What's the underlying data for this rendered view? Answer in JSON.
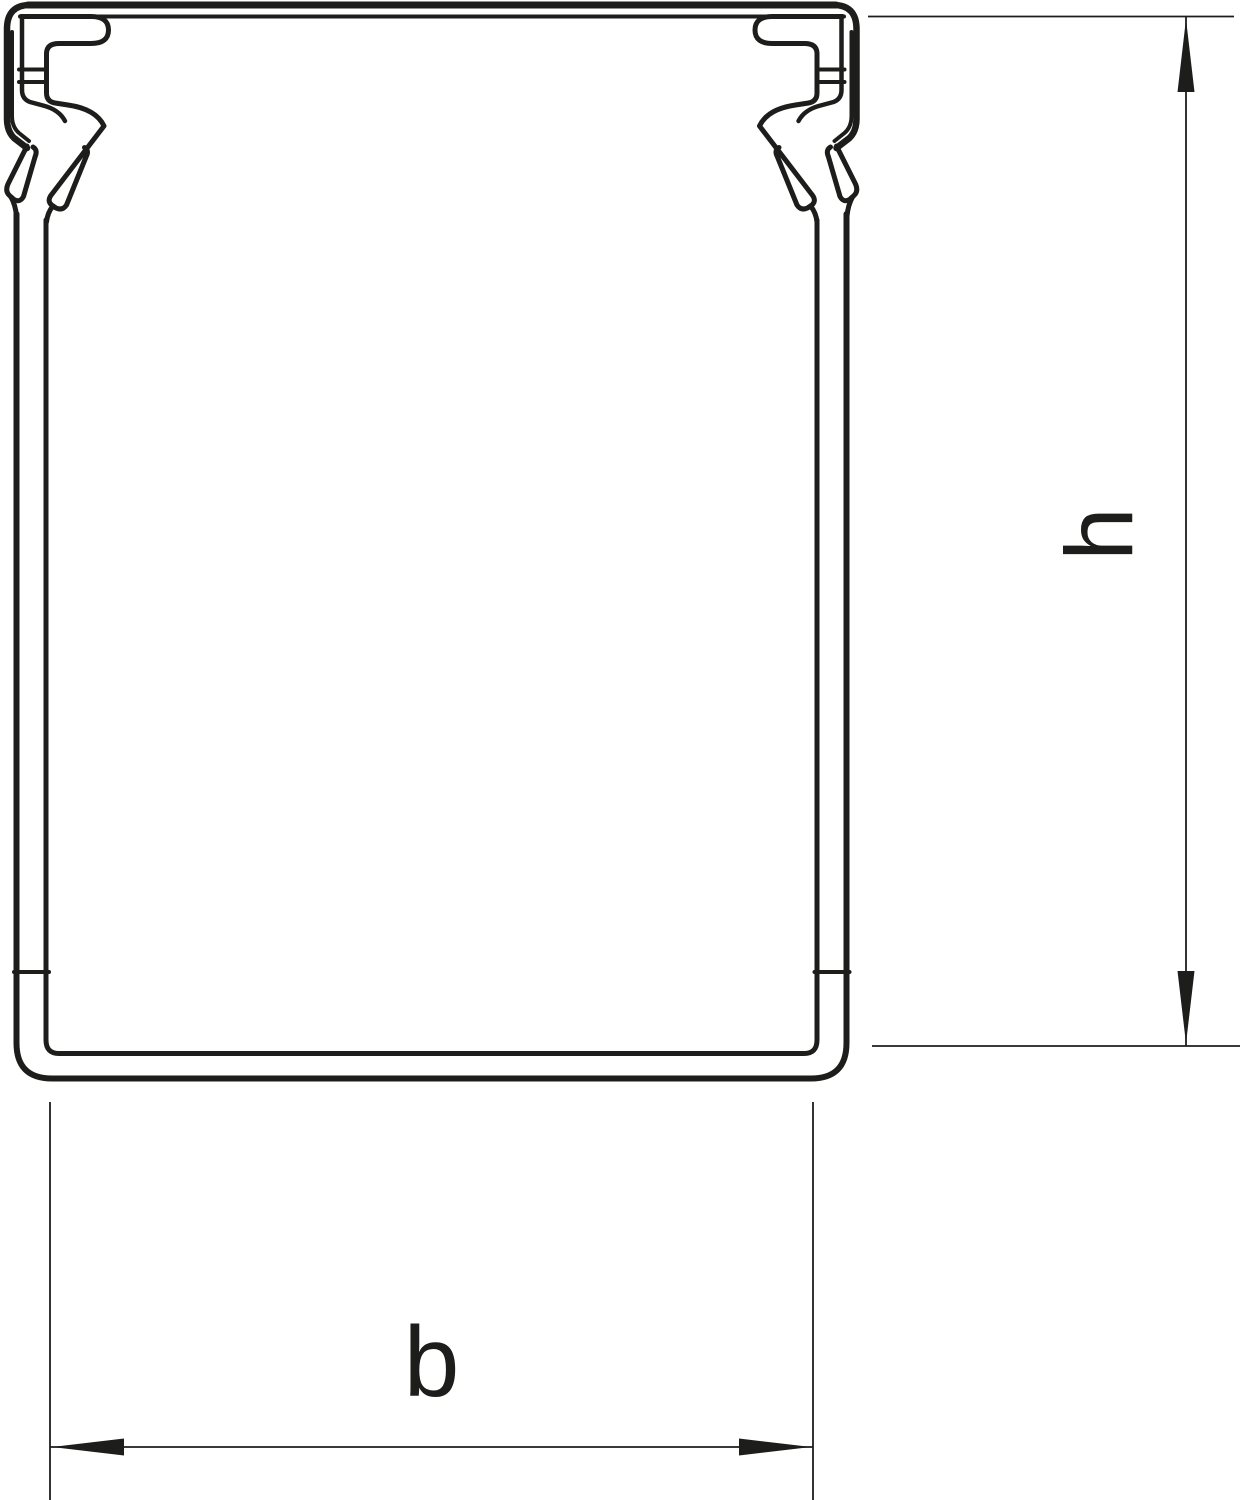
{
  "drawing": {
    "title": "Cable trunking profile cross-section",
    "description": "Technical line drawing of a wiring duct (cable trunking) cross-section with snap-on cover clips at both upper corners",
    "labels": {
      "height": "h",
      "width": "b"
    }
  },
  "colors": {
    "line": "#1d1d1b",
    "background": "#ffffff"
  }
}
